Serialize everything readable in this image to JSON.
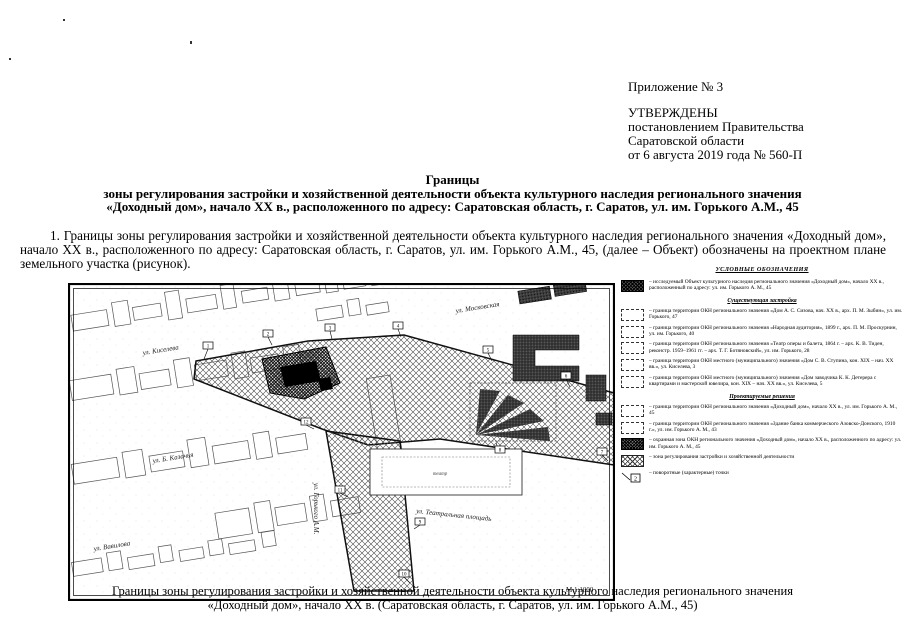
{
  "document": {
    "appendix": "Приложение № 3",
    "approval": [
      "УТВЕРЖДЕНЫ",
      "постановлением Правительства",
      "Саратовской области",
      "от 6 августа 2019 года № 560-П"
    ],
    "title_lines": [
      "Границы",
      "зоны регулирования застройки и хозяйственной деятельности объекта культурного наследия регионального значения",
      "«Доходный дом», начало XX в., расположенного по адресу: Саратовская область, г. Саратов, ул. им. Горького А.М., 45"
    ],
    "paragraph": "1. Границы зоны регулирования застройки и хозяйственной деятельности объекта культурного наследия регионального значения «Доходный дом», начало XX в., расположенного по адресу: Саратовская область, г. Саратов, ул. им. Горького А.М., 45, (далее – Объект) обозначены на проектном плане земельного участка (рисунок).",
    "caption_lines": [
      "Границы зоны регулирования застройки и хозяйственной деятельности объекта культурного наследия регионального значения",
      "«Доходный дом», начало XX в. (Саратовская область, г. Саратов, ул. им. Горького А.М., 45)"
    ]
  },
  "map": {
    "scale_label": "М 1:1000",
    "theater_label": "театр",
    "streets": {
      "kiseleva": "ул. Киселева",
      "moskovskaya": "ул. Московская",
      "kazachya": "ул. Б. Казачья",
      "vavilova": "ул. Вавилова",
      "teatralnaya": "ул. Театральная площадь",
      "gorkogo": "ул. Горького А.М."
    },
    "points": [
      "1",
      "2",
      "3",
      "4",
      "5",
      "6",
      "7",
      "8",
      "9",
      "10",
      "11",
      "12"
    ]
  },
  "legend": {
    "title": "УСЛОВНЫЕ ОБОЗНАЧЕНИЯ",
    "object_item": "– исследуемый Объект культурного наследия регионального значения «Доходный дом», начало XX в., расположенный по адресу: ул. им. Горького А. М., 45",
    "point_swatch_number": "2",
    "sections": [
      {
        "heading": "Существующая застройка",
        "items": [
          "– граница территории ОКН регионального значения «Дом А. С. Сизова, нач. XX в., арх. П. М. Зыбин», ул. им. Горького, 47",
          "– граница территории ОКН регионального значения «Народная аудитория», 1899 г., арх. П. М. Проскурнин, ул. им. Горького, 40",
          "– граница территории ОКН регионального значения «Театр оперы и балета, 1864 г. – арх. К. В. Тиден, реконстр. 1959–1961 гг. – арх. Т. Г. Ботяновский», ул. им. Горького, 28",
          "– граница территории ОКН местного (муниципального) значения «Дом С. В. Ступина, кон. XIX – нач. XX вв.», ул. Киселева, 3",
          "– граница территории ОКН местного (муниципального) значения «Дом заводчика К. К. Детерера с квартирами и мастерской ювелира, кон. XIX – нач. XX вв.», ул. Киселева, 5"
        ]
      },
      {
        "heading": "Проектируемые решения",
        "items": [
          "– граница территории ОКН регионального значения «Доходный дом», начало XX в., ул. им. Горького А. М., 45",
          "– граница территории ОКН регионального значения «Здание банка коммерческого Азовско-Донского, 1910 г.», ул. им. Горького А. М., 43",
          "– охранная зона ОКН регионального значения «Доходный дом», начало XX в., расположенного по адресу: ул. им. Горького А. М., 45",
          "– зона регулирования застройки и хозяйственной деятельности",
          "– поворотные (характерные) точки"
        ]
      }
    ]
  }
}
